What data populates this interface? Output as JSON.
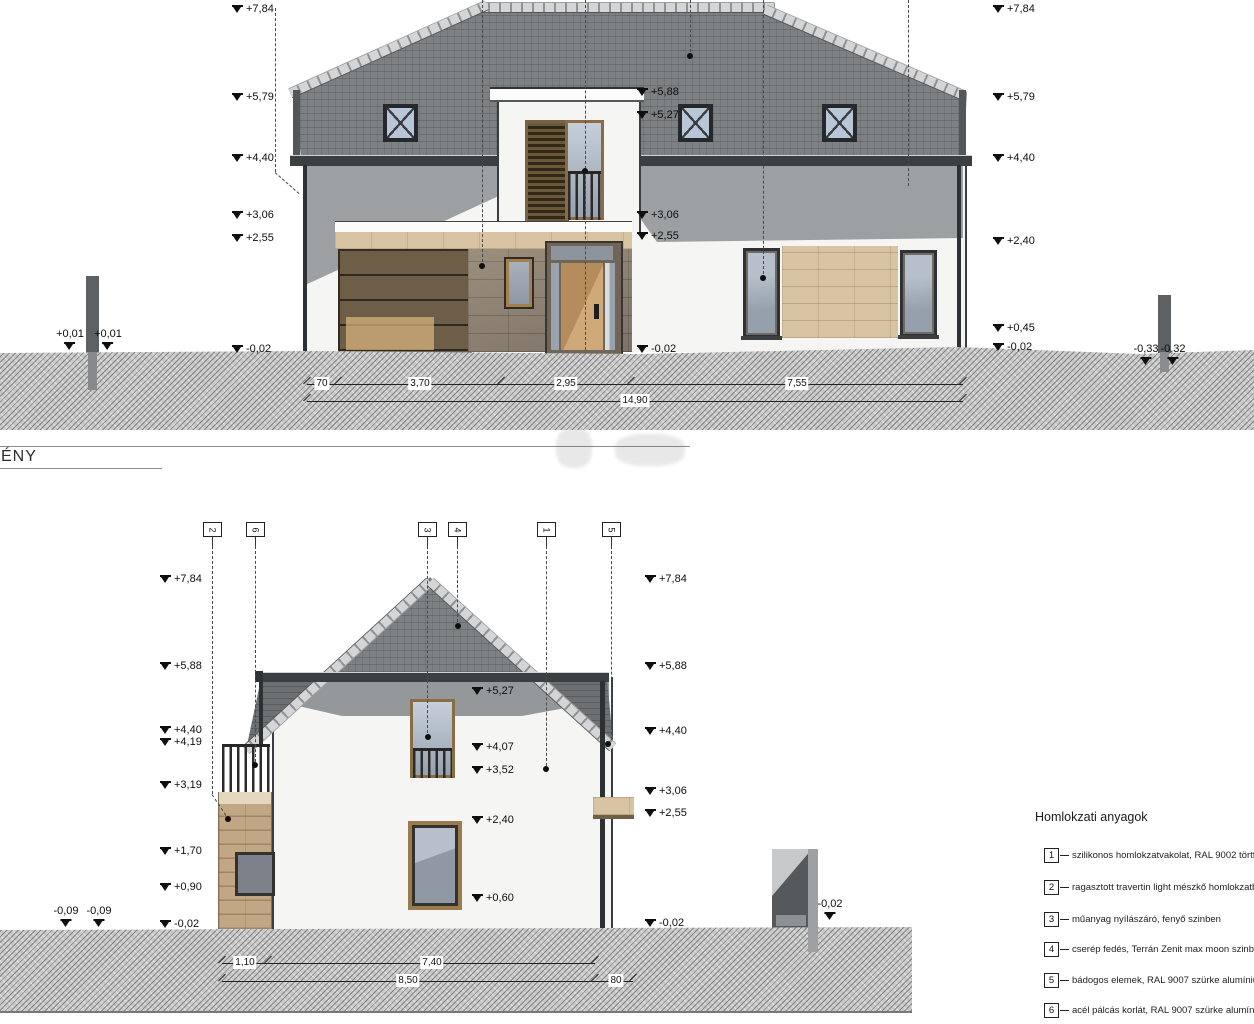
{
  "sheet": {
    "elevation_label": "ÉNY"
  },
  "colors": {
    "roof": "#7e8183",
    "ridge": "#d3d5d6",
    "wall": "#f5f5f3",
    "shadow": "#9da0a2",
    "travertine": "#d8c3a2",
    "stone": "#8b8073",
    "wood": "#c09a66",
    "wood-dark": "#5f4f33",
    "glass": "#a6b0ba",
    "ground": "#c9c9c9",
    "line": "#1c1c1c",
    "metal": "#5e6163"
  },
  "legend": {
    "title": "Homlokzati anyagok",
    "items": [
      {
        "num": "1",
        "y": 848,
        "text": "szilikonos homlokzatvakolat, RAL 9002 törtfehér"
      },
      {
        "num": "2",
        "y": 880,
        "text": "ragasztott travertin light mészkő homlokzatburkolat"
      },
      {
        "num": "3",
        "y": 912,
        "text": "műanyag nyílászáró, fenyő szinben"
      },
      {
        "num": "4",
        "y": 942,
        "text": "cserép fedés, Terrán Zenit max moon szinben"
      },
      {
        "num": "5",
        "y": 973,
        "text": "bádogos elemek, RAL 9007 szürke alumínium"
      },
      {
        "num": "6",
        "y": 1003,
        "text": "acél pálcás korlát, RAL 9007 szürke alumínium"
      }
    ]
  },
  "top_elevation": {
    "levels": [
      {
        "x": 232,
        "y": 4,
        "t": "+7,84"
      },
      {
        "x": 232,
        "y": 92,
        "t": "+5,79"
      },
      {
        "x": 232,
        "y": 153,
        "t": "+4,40"
      },
      {
        "x": 232,
        "y": 210,
        "t": "+3,06"
      },
      {
        "x": 232,
        "y": 233,
        "t": "+2,55"
      },
      {
        "x": 232,
        "y": 344,
        "t": "-0,02"
      },
      {
        "x": 637,
        "y": 87,
        "t": "+5,88"
      },
      {
        "x": 637,
        "y": 110,
        "t": "+5,27"
      },
      {
        "x": 637,
        "y": 210,
        "t": "+3,06"
      },
      {
        "x": 637,
        "y": 231,
        "t": "+2,55"
      },
      {
        "x": 637,
        "y": 344,
        "t": "-0,02"
      },
      {
        "x": 993,
        "y": 4,
        "t": "+7,84"
      },
      {
        "x": 993,
        "y": 92,
        "t": "+5,79"
      },
      {
        "x": 993,
        "y": 153,
        "t": "+4,40"
      },
      {
        "x": 993,
        "y": 236,
        "t": "+2,40"
      },
      {
        "x": 993,
        "y": 323,
        "t": "+0,45"
      },
      {
        "x": 993,
        "y": 342,
        "t": "-0,02"
      }
    ],
    "site_levels": [
      {
        "x": 70,
        "y": 329,
        "t": "+0,01"
      },
      {
        "x": 108,
        "y": 329,
        "t": "+0,01"
      },
      {
        "x": 1146,
        "y": 344,
        "t": "-0,33"
      },
      {
        "x": 1173,
        "y": 344,
        "t": "-0,32"
      }
    ],
    "dim_rows": [
      {
        "y": 384,
        "x1": 307,
        "x2": 963,
        "ticks": [
          307,
          338,
          501,
          631,
          963
        ],
        "labels": [
          {
            "x": 322,
            "t": "70"
          },
          {
            "x": 420,
            "t": "3,70"
          },
          {
            "x": 566,
            "t": "2,95"
          },
          {
            "x": 797,
            "t": "7,55"
          }
        ]
      },
      {
        "y": 401,
        "x1": 307,
        "x2": 963,
        "ticks": [
          307,
          963
        ],
        "labels": [
          {
            "x": 635,
            "t": "14,90"
          }
        ]
      }
    ],
    "leaders": [
      {
        "x": 275,
        "y1": 8,
        "y2": 172
      },
      {
        "x": 482,
        "y1": 0,
        "y2": 262
      },
      {
        "x": 585,
        "y1": 0,
        "y2": 350
      },
      {
        "x": 690,
        "y1": 0,
        "y2": 52
      },
      {
        "x": 763,
        "y1": 0,
        "y2": 274
      },
      {
        "x": 908,
        "y1": 0,
        "y2": 186
      }
    ],
    "diagonals": [
      {
        "x1": 275,
        "y1": 172,
        "x2": 299,
        "y2": 193
      }
    ],
    "dots": [
      {
        "x": 482,
        "y": 266
      },
      {
        "x": 690,
        "y": 56
      },
      {
        "x": 763,
        "y": 278
      },
      {
        "x": 585,
        "y": 171
      }
    ]
  },
  "bottom_elevation": {
    "tags": [
      {
        "x": 212,
        "n": "2",
        "drop": 794
      },
      {
        "x": 255,
        "n": "6",
        "drop": 762
      },
      {
        "x": 427,
        "n": "3",
        "drop": 733
      },
      {
        "x": 457,
        "n": "4",
        "drop": 622
      },
      {
        "x": 546,
        "n": "1",
        "drop": 766
      },
      {
        "x": 611,
        "n": "5",
        "drop": 740
      }
    ],
    "levels": [
      {
        "x": 160,
        "y": 574,
        "t": "+7,84"
      },
      {
        "x": 160,
        "y": 661,
        "t": "+5,88"
      },
      {
        "x": 160,
        "y": 725,
        "t": "+4,40"
      },
      {
        "x": 160,
        "y": 737,
        "t": "+4,19"
      },
      {
        "x": 160,
        "y": 780,
        "t": "+3,19"
      },
      {
        "x": 160,
        "y": 846,
        "t": "+1,70"
      },
      {
        "x": 160,
        "y": 882,
        "t": "+0,90"
      },
      {
        "x": 160,
        "y": 919,
        "t": "-0,02"
      },
      {
        "x": 472,
        "y": 686,
        "t": "+5,27"
      },
      {
        "x": 472,
        "y": 742,
        "t": "+4,07"
      },
      {
        "x": 472,
        "y": 765,
        "t": "+3,52"
      },
      {
        "x": 472,
        "y": 815,
        "t": "+2,40"
      },
      {
        "x": 472,
        "y": 893,
        "t": "+0,60"
      },
      {
        "x": 645,
        "y": 574,
        "t": "+7,84"
      },
      {
        "x": 645,
        "y": 661,
        "t": "+5,88"
      },
      {
        "x": 645,
        "y": 726,
        "t": "+4,40"
      },
      {
        "x": 645,
        "y": 786,
        "t": "+3,06"
      },
      {
        "x": 645,
        "y": 808,
        "t": "+2,55"
      },
      {
        "x": 645,
        "y": 918,
        "t": "-0,02"
      }
    ],
    "site_levels": [
      {
        "x": 66,
        "y": 906,
        "t": "-0,09"
      },
      {
        "x": 99,
        "y": 906,
        "t": "-0,09"
      },
      {
        "x": 830,
        "y": 899,
        "t": "-0,02"
      }
    ],
    "dim_rows": [
      {
        "y": 963,
        "x1": 222,
        "x2": 595,
        "ticks": [
          222,
          268,
          595
        ],
        "labels": [
          {
            "x": 245,
            "t": "1,10"
          },
          {
            "x": 432,
            "t": "7,40"
          }
        ]
      },
      {
        "y": 981,
        "x1": 222,
        "x2": 633,
        "ticks": [
          222,
          595,
          633
        ],
        "labels": [
          {
            "x": 408,
            "t": "8,50"
          },
          {
            "x": 616,
            "t": "80"
          }
        ]
      }
    ],
    "leaders": [],
    "diagonals": [
      {
        "x1": 212,
        "y1": 794,
        "x2": 226,
        "y2": 815
      }
    ],
    "dots": [
      {
        "x": 228,
        "y": 819
      },
      {
        "x": 255,
        "y": 765
      },
      {
        "x": 428,
        "y": 737
      },
      {
        "x": 458,
        "y": 626
      },
      {
        "x": 546,
        "y": 769
      },
      {
        "x": 608,
        "y": 744
      }
    ]
  }
}
